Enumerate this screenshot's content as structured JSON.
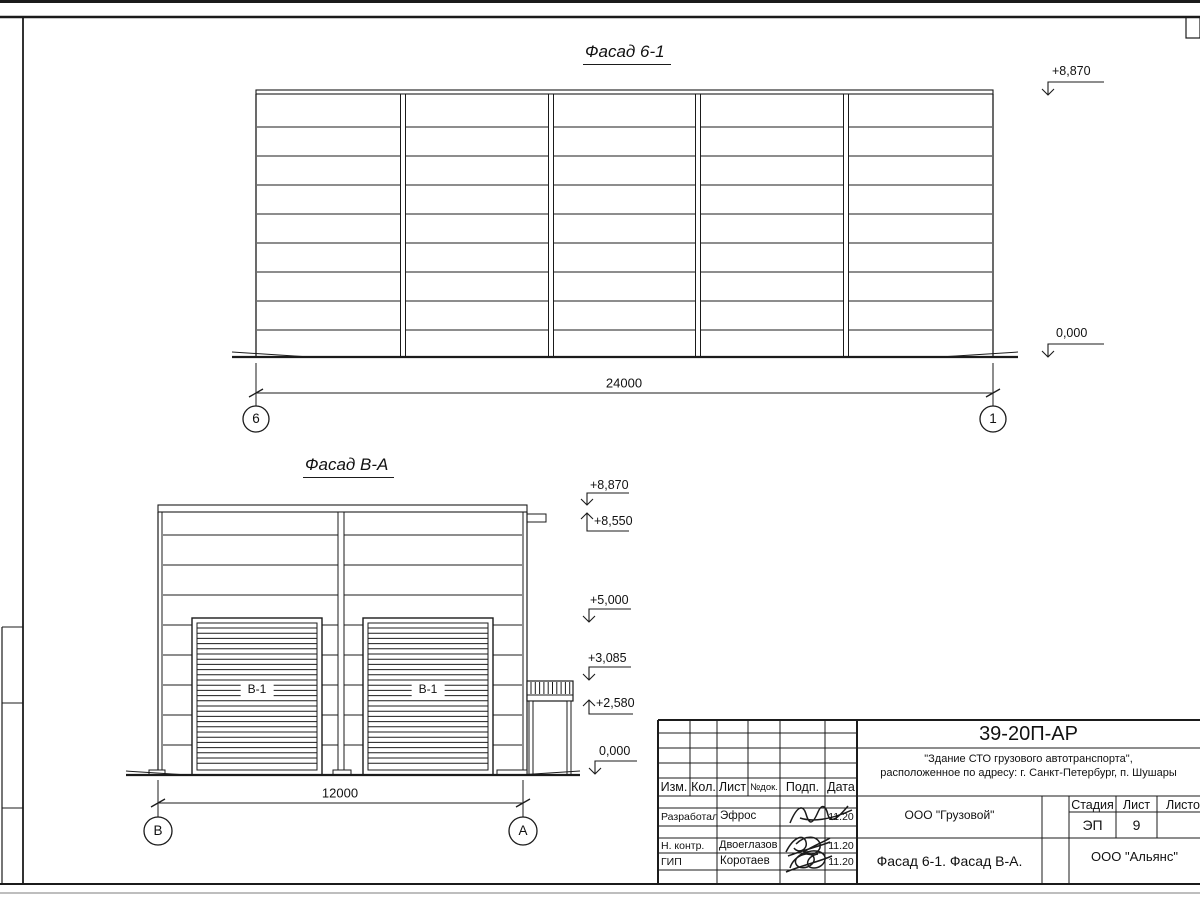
{
  "drawing": {
    "facade1": {
      "title": "Фасад 6-1",
      "dimension": "24000",
      "axis_left": "6",
      "axis_right": "1",
      "elev_top": "+8,870",
      "elev_zero": "0,000"
    },
    "facade2": {
      "title": "Фасад В-А",
      "dimension": "12000",
      "axis_left": "В",
      "axis_right": "А",
      "gate_label": "В-1",
      "elev": [
        "+8,870",
        "+8,550",
        "+5,000",
        "+3,085",
        "+2,580",
        "0,000"
      ]
    }
  },
  "titleblock": {
    "doc_number": "39-20П-АР",
    "project_line1": "\"Здание СТО грузового автотранспорта\",",
    "project_line2": "расположенное по адресу: г. Санкт-Петербург, п. Шушары",
    "organization": "ООО \"Грузовой\"",
    "sheet_name": "Фасад 6-1. Фасад В-А.",
    "contractor": "ООО \"Альянс\"",
    "stage_label": "Стадия",
    "list_label": "Лист",
    "lists_label": "Листов",
    "stage": "ЭП",
    "list_number": "9",
    "cols": [
      "Изм.",
      "Кол.",
      "Лист",
      "№док.",
      "Подп.",
      "Дата"
    ],
    "rows": [
      {
        "role": "Разработал",
        "name": "Эфрос",
        "date": "11.20"
      },
      {
        "role": "Н. контр.",
        "name": "Двоеглазов",
        "date": "11.20"
      },
      {
        "role": "ГИП",
        "name": "Коротаев",
        "date": "11.20"
      }
    ]
  }
}
